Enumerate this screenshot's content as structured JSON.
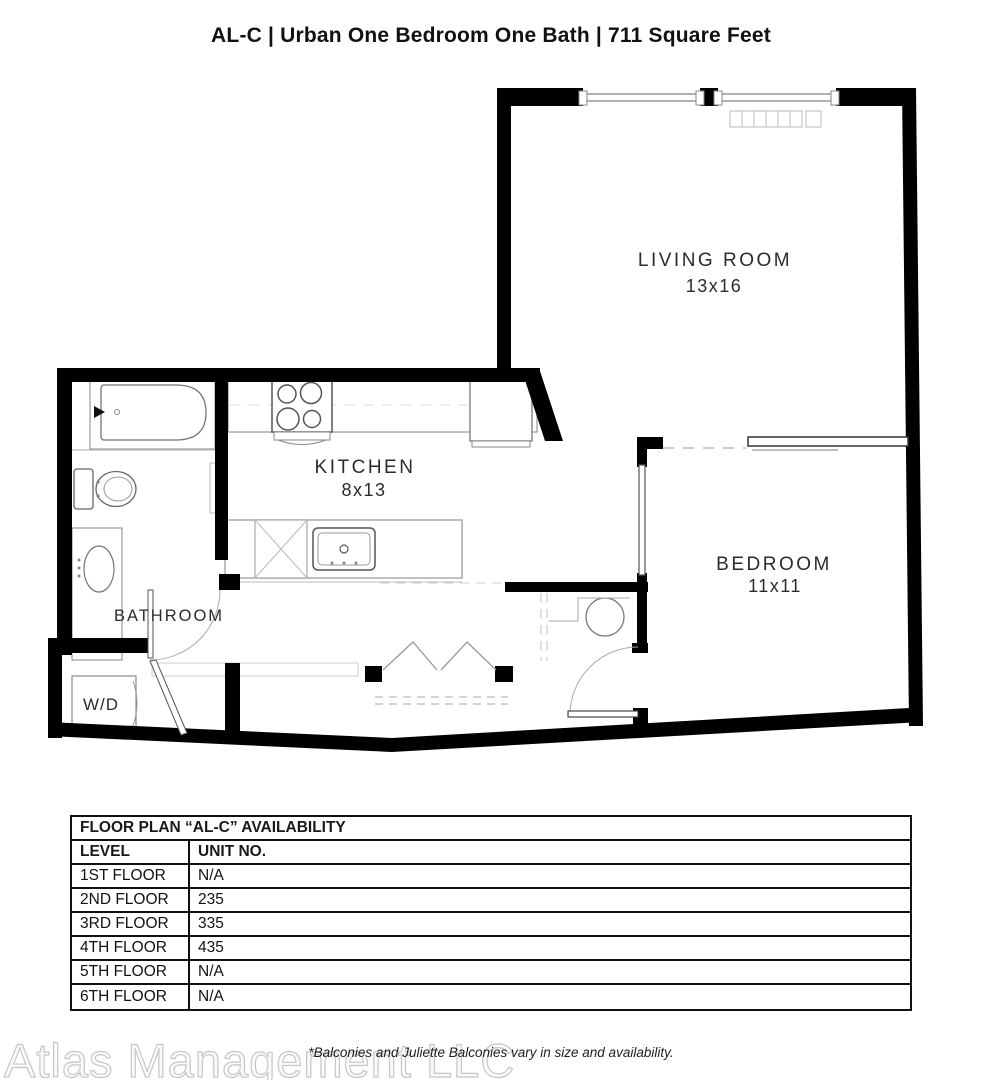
{
  "page": {
    "title": "AL-C | Urban One Bedroom One Bath | 711 Square Feet",
    "footnote": "*Balconies and Juliette Balconies vary in size and availability.",
    "watermark": "Atlas Management LLC"
  },
  "floor_plan": {
    "rooms": [
      {
        "name": "LIVING ROOM",
        "dimensions": "13x16"
      },
      {
        "name": "KITCHEN",
        "dimensions": "8x13"
      },
      {
        "name": "BEDROOM",
        "dimensions": "11x11"
      },
      {
        "name": "BATHROOM",
        "dimensions": ""
      },
      {
        "name": "W/D",
        "dimensions": ""
      }
    ]
  },
  "availability_table": {
    "title": "FLOOR PLAN “AL-C” AVAILABILITY",
    "columns": [
      "LEVEL",
      "UNIT NO."
    ],
    "rows": [
      {
        "level": "1ST FLOOR",
        "unit": "N/A"
      },
      {
        "level": "2ND FLOOR",
        "unit": "235"
      },
      {
        "level": "3RD FLOOR",
        "unit": "335"
      },
      {
        "level": "4TH FLOOR",
        "unit": "435"
      },
      {
        "level": "5TH FLOOR",
        "unit": "N/A"
      },
      {
        "level": "6TH FLOOR",
        "unit": "N/A"
      }
    ]
  },
  "colors": {
    "wall": "#000000",
    "fixture_line": "#999999",
    "label_text": "#2b2b2b",
    "watermark": "#c6c6c6"
  }
}
